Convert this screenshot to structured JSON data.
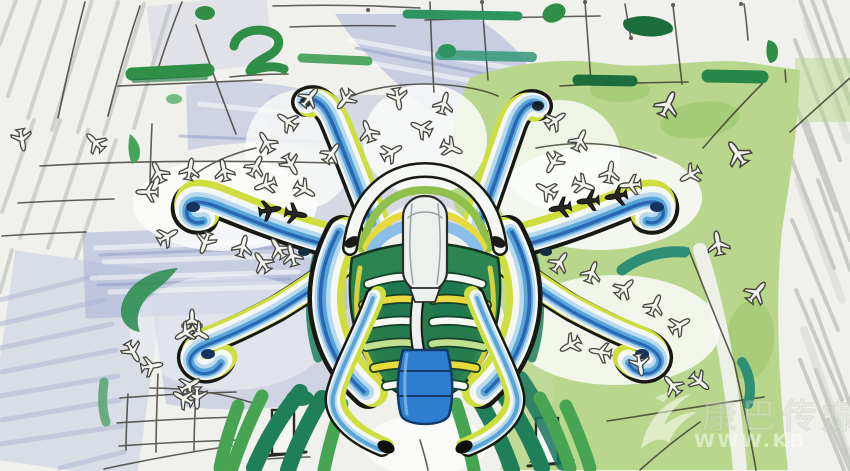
{
  "scene": {
    "alt_text": "Hand-drawn marker concept sketch, aerial master-plan view of a starfish-shaped airport terminal with six curved pier arms lined with parked aircraft, blue-gray washes, green landscaping strokes and pencil grid lines on white paper"
  },
  "watermark": {
    "logo_icon": "swoosh-bird-logo",
    "logo_text": "康巴传媒",
    "url_text": "WWW.KB"
  },
  "palette": {
    "paper": "#f0f1ed",
    "pencil": "#3a372e",
    "hatch": "#b0b3ab",
    "wash": "#aeb6d8",
    "wash_deep": "#8f9ac4",
    "field": "#b9d78c",
    "field_dark": "#9cc76e",
    "marker_green": "#2f8f47",
    "marker_dark": "#1b6e3c",
    "marker_teal": "#2e8f74",
    "ink": "#191914",
    "band_white": "#f4f7f4",
    "band_lblue": "#b9d9ee",
    "band_mblue": "#58a6d8",
    "band_dblue": "#2b66b4",
    "band_ygreen": "#cede3e",
    "collar_green": "#8fc04c",
    "accent_yellow": "#e8d93c",
    "accent_blue": "#8abde8",
    "shield": "#2b8550",
    "shield_dark": "#17402a",
    "capsule": "#edf1ee",
    "tail_blue": "#2e7fd2",
    "plane_fill": "#f2f2ee",
    "plane_line": "#45453e",
    "wm": "#ffffff"
  }
}
